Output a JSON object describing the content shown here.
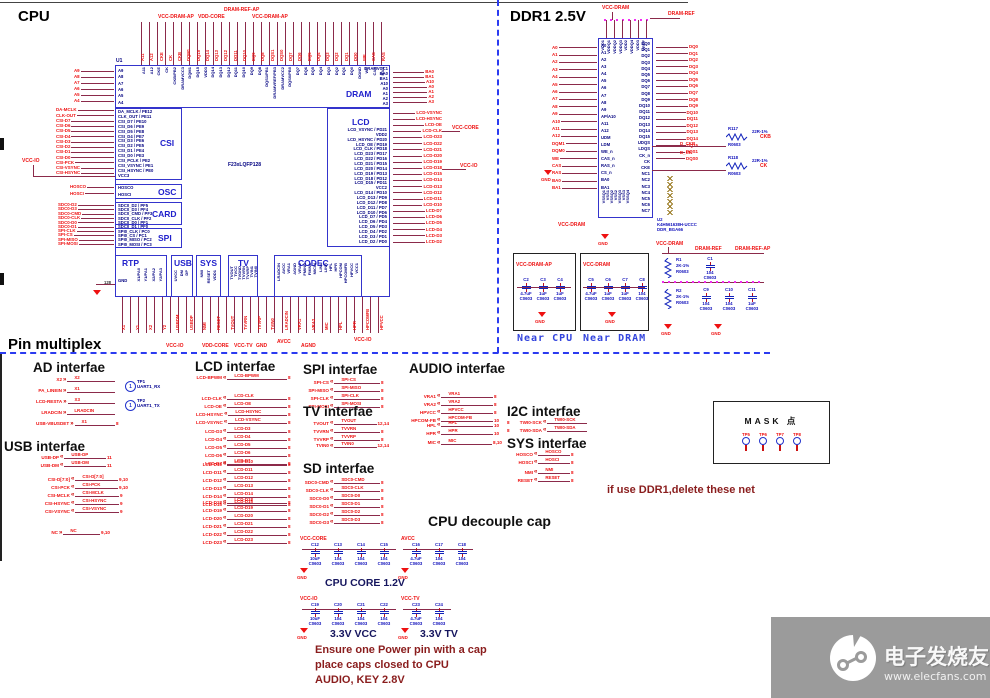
{
  "titles": {
    "cpu": "CPU",
    "ddr": "DDR1 2.5V",
    "pinmux": "Pin multiplex"
  },
  "cpu": {
    "ref": "U1",
    "part": "F23xLQFP128",
    "blocks": {
      "dram": "DRAM",
      "csi": "CSI",
      "osc": "OSC",
      "card": "CARD",
      "spi": "SPI",
      "lcd": "LCD",
      "rtp": "RTP",
      "usb": "USB",
      "sys": "SYS",
      "tv": "TV",
      "codec": "CODEC"
    },
    "top_power": [
      "VCC-DRAM-AP",
      "VDD-CORE",
      "DRAM-REF-AP",
      "VCC-DRAM-AP"
    ],
    "top_pins": [
      "A11",
      "A12",
      "CKE",
      "CK",
      "CKB/PB2",
      "DRAMVCC3",
      "DQM1",
      "DQ15",
      "VDD3",
      "DQ14",
      "DQ13",
      "DQ12",
      "DQ11",
      "DQ10",
      "DQ9",
      "DQ8",
      "DQS1/PB1",
      "DRAMVREF/PB3",
      "DRAMVCC2",
      "DQS0/PB0",
      "DQ7",
      "DQ6",
      "DQ5",
      "DQ4",
      "DQ3",
      "DQ2",
      "DQ1",
      "DQ0",
      "DGND",
      "WE",
      "CAS",
      "RAS"
    ],
    "top_nets": [
      "A11",
      "A12",
      "CKE",
      "CK",
      "CKB",
      "DQM1",
      "DQ15",
      "DQ14",
      "DQ13",
      "DQ12",
      "DQ11",
      "DQ10",
      "DQ9",
      "DQ8",
      "DQS1",
      "DQS0",
      "DQ7",
      "DQ6",
      "DQ5",
      "DQ4",
      "DQ3",
      "DQ2",
      "DQ1",
      "DQ0",
      "WE",
      "CAS",
      "RAS"
    ],
    "dram_left_pins": [
      "A9",
      "A8",
      "A7",
      "A6",
      "A5",
      "A4"
    ],
    "dram_left_nets": [
      "A9",
      "A8",
      "A7",
      "A6",
      "A5",
      "A4"
    ],
    "dram_right_pins": [
      "DRAMVCC1",
      "BA0",
      "BA1",
      "A10",
      "A0",
      "A1",
      "A2",
      "A3"
    ],
    "dram_right_nets": [
      "BA0",
      "BA1",
      "A10",
      "A0",
      "A1",
      "A2",
      "A3"
    ],
    "csi_pins": [
      "DA_MCLK / PE12",
      "CLK_OUT / PE11",
      "CSI_D7 / PE10",
      "CSI_D6 / PE9",
      "CSI_D5 / PE8",
      "CSI_D4 / PE7",
      "CSI_D3 / PE6",
      "CSI_D2 / PE5",
      "CSI_D1 / PE4",
      "CSI_D0 / PE3",
      "CSI_PCLK / PE2",
      "CSI_VSYNC / PE1",
      "CSI_HSYNC / PE0",
      "VCC3"
    ],
    "csi_nets": [
      "DA-MCLK",
      "CLK-OUT",
      "CSI-D7",
      "CSI-D6",
      "CSI-D5",
      "CSI-D4",
      "CSI-D3",
      "CSI-D2",
      "CSI-D1",
      "CSI-D0",
      "CSI-PCK",
      "CSI-VSYNC",
      "CSI-HSYNC"
    ],
    "osc_pins": [
      "HOSCO",
      "HOSCI"
    ],
    "osc_nets": [
      "HOSCO",
      "HOSCI"
    ],
    "card_pins": [
      "SDC0_D2 / PF5",
      "SDC0_D3 / PF4",
      "SDC0_CMD / PF3",
      "SDC0_CLK / PF2",
      "SDC0_D0 / PF1",
      "SDC0_D1 / PF0"
    ],
    "card_nets": [
      "SDC0-D2",
      "SDC0-D3",
      "SDC0-CMD",
      "SDC0-CLK",
      "SDC0-D0",
      "SDC0-D1"
    ],
    "spi_pins": [
      "SPI0_CLK / PC0",
      "SPI0_CS / PC1",
      "SPI0_MISO / PC2",
      "SPI0_MOSI / PC3"
    ],
    "spi_nets": [
      "SPI-CLK",
      "SPI-CS",
      "SPI-MISO",
      "SPI-MOSI"
    ],
    "lcd_pins": [
      "LCD_VSYNC / PD21",
      "VDD2",
      "LCD_HSYNC / PD20",
      "LCD_OE / PD19",
      "LCD_CLK / PD18",
      "LCD_D23 / PD17",
      "LCD_D22 / PD16",
      "LCD_D21 / PD15",
      "LCD_D20 / PD14",
      "LCD_D19 / PD13",
      "LCD_D18 / PD12",
      "LCD_D15 / PD11",
      "VCC2",
      "LCD_D14 / PD10",
      "LCD_D13 / PD9",
      "LCD_D12 / PD8",
      "LCD_D11 / PD7",
      "LCD_D10 / PD6",
      "LCD_D7 / PD5",
      "LCD_D6 / PD4",
      "LCD_D5 / PD3",
      "LCD_D4 / PD2",
      "LCD_D3 / PD1",
      "LCD_D2 / PD0"
    ],
    "lcd_nets": [
      "LCD-VSYNC",
      "LCD-HSYNC",
      "LCD-OE",
      "LCD-CLK",
      "LCD-D23",
      "LCD-D22",
      "LCD-D21",
      "LCD-D20",
      "LCD-D19",
      "LCD-D18",
      "LCD-D15",
      "LCD-D14",
      "LCD-D13",
      "LCD-D12",
      "LCD-D11",
      "LCD-D10",
      "LCD-D7",
      "LCD-D6",
      "LCD-D5",
      "LCD-D4",
      "LCD-D3",
      "LCD-D2"
    ],
    "rtp_gnd": "GND",
    "rtp_pinno": "128",
    "rtp_pins": [
      "X1/PA0",
      "Y1/PA1",
      "X2/PA2",
      "Y2/PA3"
    ],
    "usb_pins": [
      "UVCC",
      "DM",
      "DP"
    ],
    "sys_pins": [
      "NMI",
      "RESET",
      "VDD1"
    ],
    "tv_pins": [
      "TVOUT",
      "TVCC",
      "TVGND",
      "TVVRN",
      "TVVRP",
      "TVIN1",
      "TVIN0"
    ],
    "codec_pins": [
      "LRADCIN",
      "AVCC",
      "VRA1",
      "AGND",
      "VRA2",
      "FMINR",
      "FMINL",
      "MICIN",
      "LINL",
      "LINR",
      "HPL",
      "HPR",
      "HPCOM",
      "HPCOMFB",
      "HPVCC",
      "VCC1"
    ],
    "bottom_nets": [
      "X1",
      "Y1",
      "X2",
      "Y2",
      "USBDM",
      "USBDP",
      "NMI",
      "RESET",
      "TVOUT",
      "TVVRN",
      "TVVRP",
      "TVIN0",
      "LRADCIN",
      "VRA1",
      "VRA2",
      "MIC",
      "HPL",
      "HPR",
      "HPCOMFB",
      "HPVCC"
    ],
    "bottom_power": [
      "VCC-IO",
      "VDD-CORE",
      "VCC-TV",
      "GND",
      "AVCC",
      "AGND",
      "VCC-IO"
    ],
    "left_power": "VCC-IO",
    "right_power": [
      "VCC-CORE",
      "VCC-IO"
    ]
  },
  "ddr": {
    "ref": "U2",
    "part": "K4H561638H-UCCC",
    "footprint": "DDR_BGA66",
    "gnd": "GND",
    "top_power": [
      "VCC-DRAM",
      "DRAM-REF"
    ],
    "bottom_power": "VCC-DRAM",
    "top_pins": [
      "VDD1",
      "VDDQ1",
      "VDDQ2",
      "VDDQ3",
      "VDD2",
      "VDDQ4",
      "VDD3",
      "VREF"
    ],
    "bottom_pins": [
      "VSSQ1",
      "VSS1",
      "VSSQ2",
      "VSS2",
      "VSSQ3",
      "VSS3",
      "VSSQ4"
    ],
    "left_pins": [
      "A0",
      "A1",
      "A2",
      "A3",
      "A4",
      "A5",
      "A6",
      "A7",
      "A8",
      "A9",
      "AP/A10",
      "A11",
      "A12",
      "UDM",
      "LDM",
      "WE_n",
      "CAS_n",
      "RAS_n",
      "CS_n",
      "BA0",
      "BA1"
    ],
    "left_nets": [
      "A0",
      "A1",
      "A2",
      "A3",
      "A4",
      "A5",
      "A6",
      "A7",
      "A8",
      "A9",
      "A10",
      "A11",
      "A12",
      "DQM1",
      "DQM0",
      "WE",
      "CAS",
      "RAS",
      "BA0",
      "BA1"
    ],
    "right_pins": [
      "DQ0",
      "DQ1",
      "DQ2",
      "DQ3",
      "DQ4",
      "DQ5",
      "DQ6",
      "DQ7",
      "DQ8",
      "DQ9",
      "DQ10",
      "DQ11",
      "DQ12",
      "DQ13",
      "DQ14",
      "DQ15",
      "UDQS",
      "LDQS",
      "CK_n",
      "CK",
      "CKE",
      "NC1",
      "NC2",
      "NC3",
      "NC4",
      "NC5",
      "NC6",
      "NC7"
    ],
    "right_nets": [
      "DQ0",
      "DQ1",
      "DQ2",
      "DQ3",
      "DQ4",
      "DQ5",
      "DQ6",
      "DQ7",
      "DQ8",
      "DQ9",
      "DQ10",
      "DQ11",
      "DQ12",
      "DQ13",
      "DQ14",
      "DQ15",
      "DQS1",
      "DQS0"
    ],
    "clk_nets": [
      "D_CKB",
      "D_CK"
    ],
    "resistors": [
      {
        "ref": "R117",
        "value": "22R-1%",
        "pkg": "R0603",
        "net": "CKB"
      },
      {
        "ref": "R118",
        "value": "22R-1%",
        "pkg": "R0603",
        "net": "CK"
      }
    ]
  },
  "near": {
    "cpu": {
      "label": "Near CPU",
      "net": "VCC-DRAM-AP",
      "gnd": "GND",
      "caps": [
        {
          "ref": "C2",
          "value": "4.7uF",
          "pkg": "C0603"
        },
        {
          "ref": "C3",
          "value": "1uF",
          "pkg": "C0603"
        },
        {
          "ref": "C4",
          "value": "1uF",
          "pkg": "C0603"
        }
      ]
    },
    "dram": {
      "label": "Near DRAM",
      "net": "VCC-DRAM",
      "gnd": "GND",
      "caps": [
        {
          "ref": "C5",
          "value": "4.7uF",
          "pkg": "C0603"
        },
        {
          "ref": "C6",
          "value": "1uF",
          "pkg": "C0603"
        },
        {
          "ref": "C7",
          "value": "1uF",
          "pkg": "C0603"
        },
        {
          "ref": "C8",
          "value": "104",
          "pkg": "C0603"
        }
      ]
    }
  },
  "refnet": {
    "power": "VCC-DRAM",
    "net1": "DRAM-REF",
    "net2": "DRAM-REF-AP",
    "gnd1": "GND",
    "gnd2": "GND",
    "r1": {
      "ref": "R1",
      "value": "2K-1%",
      "pkg": "R0603"
    },
    "r2": {
      "ref": "R2",
      "value": "2K-1%",
      "pkg": "R0603"
    },
    "c1": {
      "ref": "C1",
      "value": "104",
      "pkg": "C0603"
    },
    "caps2": [
      {
        "ref": "C9",
        "value": "104",
        "pkg": "C0603"
      },
      {
        "ref": "C10",
        "value": "104",
        "pkg": "C0603"
      },
      {
        "ref": "C11",
        "value": "1uF",
        "pkg": "C0603"
      }
    ]
  },
  "pinmux": {
    "ad": {
      "title": "AD interfae",
      "rows": [
        {
          "name": "X2",
          "net": "X2"
        },
        {
          "name": "PA_LINEIN",
          "net": "X1"
        },
        {
          "name": "LCD-RESTA",
          "net": "X3"
        },
        {
          "name": "LRADCIN",
          "net": "LRADCIN"
        },
        {
          "name": "USB-VBUSDET",
          "net": "X1",
          "page": "8"
        }
      ],
      "tps": [
        {
          "ref": "TP1",
          "net": "UART1_RX",
          "num": "1"
        },
        {
          "ref": "TP2",
          "net": "UART1_TX",
          "num": "1"
        }
      ]
    },
    "usb": {
      "title": "USB interfae",
      "g1": [
        {
          "name": "USB-DP",
          "page": "11"
        },
        {
          "name": "USB-DM",
          "page": "11"
        }
      ],
      "g2": [
        {
          "name": "CSI-D[7:0]",
          "page": "9,10"
        },
        {
          "name": "CSI-PCK",
          "page": "9,10"
        },
        {
          "name": "CSI-MCLK",
          "page": "9"
        },
        {
          "name": "CSI-HSYNC",
          "page": "9"
        },
        {
          "name": "CSI-VSYNC",
          "page": "9"
        }
      ],
      "g3": [
        {
          "name": "NC",
          "page": "9,10"
        }
      ]
    },
    "lcd": {
      "title": "LCD interfae",
      "g0": [
        {
          "name": "LCD-BPWM",
          "page": "8"
        }
      ],
      "g1": [
        {
          "name": "LCD-CLK",
          "page": "8"
        },
        {
          "name": "LCD-OE",
          "page": "8"
        },
        {
          "name": "LCD-HSYNC",
          "page": "8"
        },
        {
          "name": "LCD-VSYNC",
          "page": "8"
        }
      ],
      "g2": [
        {
          "name": "LCD-D3",
          "page": "8"
        },
        {
          "name": "LCD-D4",
          "page": "8"
        },
        {
          "name": "LCD-D5",
          "page": "8"
        },
        {
          "name": "LCD-D6",
          "page": "8"
        },
        {
          "name": "LCD-D7",
          "page": "8"
        }
      ],
      "g3": [
        {
          "name": "LCD-D10",
          "page": "8"
        },
        {
          "name": "LCD-D11",
          "page": "8"
        },
        {
          "name": "LCD-D12",
          "page": "8"
        },
        {
          "name": "LCD-D13",
          "page": "8"
        },
        {
          "name": "LCD-D14",
          "page": "8"
        },
        {
          "name": "LCD-D15",
          "page": "8"
        }
      ],
      "g4": [
        {
          "name": "LCD-D18",
          "page": "8"
        },
        {
          "name": "LCD-D19",
          "page": "8"
        },
        {
          "name": "LCD-D20",
          "page": "8"
        },
        {
          "name": "LCD-D21",
          "page": "8"
        },
        {
          "name": "LCD-D22",
          "page": "8"
        },
        {
          "name": "LCD-D23",
          "page": "8"
        }
      ]
    },
    "spi": {
      "title": "SPI interfae",
      "g1": [
        {
          "name": "SPI-CS",
          "page": "8"
        },
        {
          "name": "SPI-MISO",
          "page": "8"
        },
        {
          "name": "SPI-CLK",
          "page": "8"
        },
        {
          "name": "SPI-MOSI",
          "page": "8"
        }
      ]
    },
    "tv": {
      "title": "TV interfae",
      "g1": [
        {
          "name": "TVOUT",
          "page": "12,14"
        },
        {
          "name": "TVVRN",
          "page": "8"
        },
        {
          "name": "TVVRP",
          "page": "8"
        }
      ],
      "g2": [
        {
          "name": "TVIN0",
          "page": "12,14"
        }
      ]
    },
    "sd": {
      "title": "SD interfae",
      "g1": [
        {
          "name": "SDC0-CMD",
          "page": "8"
        },
        {
          "name": "SDC0-CLK",
          "page": "8"
        },
        {
          "name": "SDC0-D0",
          "page": "8"
        },
        {
          "name": "SDC0-D1",
          "page": "8"
        },
        {
          "name": "SDC0-D2",
          "page": "8"
        },
        {
          "name": "SDC0-D3",
          "page": "8"
        }
      ]
    },
    "audio": {
      "title": "AUDIO interfae",
      "g1": [
        {
          "name": "VRA1",
          "page": "8"
        },
        {
          "name": "VRA2",
          "page": "8"
        },
        {
          "name": "HPVCC",
          "page": "8"
        },
        {
          "name": "HPCOM-FB",
          "page": "10"
        }
      ],
      "g2": [
        {
          "name": "HPL",
          "page": "10"
        },
        {
          "name": "HPR",
          "page": "10"
        }
      ],
      "g3": [
        {
          "name": "MIC",
          "page": "8,10"
        }
      ]
    },
    "i2c": {
      "title": "I2C interfae",
      "g1": [
        {
          "name": "TWI0-SCK",
          "page": "8"
        },
        {
          "name": "TWI0-SDA",
          "page": "8"
        }
      ]
    },
    "sys": {
      "title": "SYS interfae",
      "g1": [
        {
          "name": "HOSCO",
          "page": "8"
        },
        {
          "name": "HOSCI",
          "page": "8"
        }
      ],
      "g2": [
        {
          "name": "NMI",
          "page": "8"
        },
        {
          "name": "RESET",
          "page": "8"
        }
      ]
    },
    "mask": {
      "title": "MASK 点",
      "tps": [
        "TP5",
        "TP6",
        "TP7",
        "TP8"
      ]
    },
    "ddr_note": "if use DDR1,delete these net"
  },
  "decouple": {
    "title": "CPU decouple cap",
    "groups": [
      {
        "net": "VCC-CORE",
        "gnd": "GND",
        "caption": "CPU CORE 1.2V",
        "caps": [
          {
            "ref": "C12",
            "value": "10uF",
            "pkg": "C0603"
          },
          {
            "ref": "C13",
            "value": "104",
            "pkg": "C0603"
          },
          {
            "ref": "C14",
            "value": "104",
            "pkg": "C0603"
          },
          {
            "ref": "C15",
            "value": "104",
            "pkg": "C0603"
          }
        ]
      },
      {
        "net": "AVCC",
        "gnd": "GND",
        "caption": "",
        "caps": [
          {
            "ref": "C16",
            "value": "4.7uF",
            "pkg": "C0603"
          },
          {
            "ref": "C17",
            "value": "104",
            "pkg": "C0603"
          },
          {
            "ref": "C18",
            "value": "104",
            "pkg": "C0603"
          }
        ]
      },
      {
        "net": "VCC-IO",
        "gnd": "GND",
        "caption": "3.3V VCC",
        "caps": [
          {
            "ref": "C19",
            "value": "10uF",
            "pkg": "C0603"
          },
          {
            "ref": "C20",
            "value": "104",
            "pkg": "C0603"
          },
          {
            "ref": "C21",
            "value": "104",
            "pkg": "C0603"
          },
          {
            "ref": "C22",
            "value": "104",
            "pkg": "C0603"
          }
        ]
      },
      {
        "net": "VCC-TV",
        "gnd": "GND",
        "caption": "3.3V TV",
        "caps": [
          {
            "ref": "C23",
            "value": "4.7uF",
            "pkg": "C0603"
          },
          {
            "ref": "C24",
            "value": "104",
            "pkg": "C0603"
          }
        ]
      }
    ]
  },
  "notes": [
    "Ensure one Power pin with a cap",
    "place caps closed to CPU",
    "AUDIO, KEY 2.8V"
  ],
  "watermark": {
    "brand": "电子发烧友",
    "url": "www.elecfans.com"
  }
}
